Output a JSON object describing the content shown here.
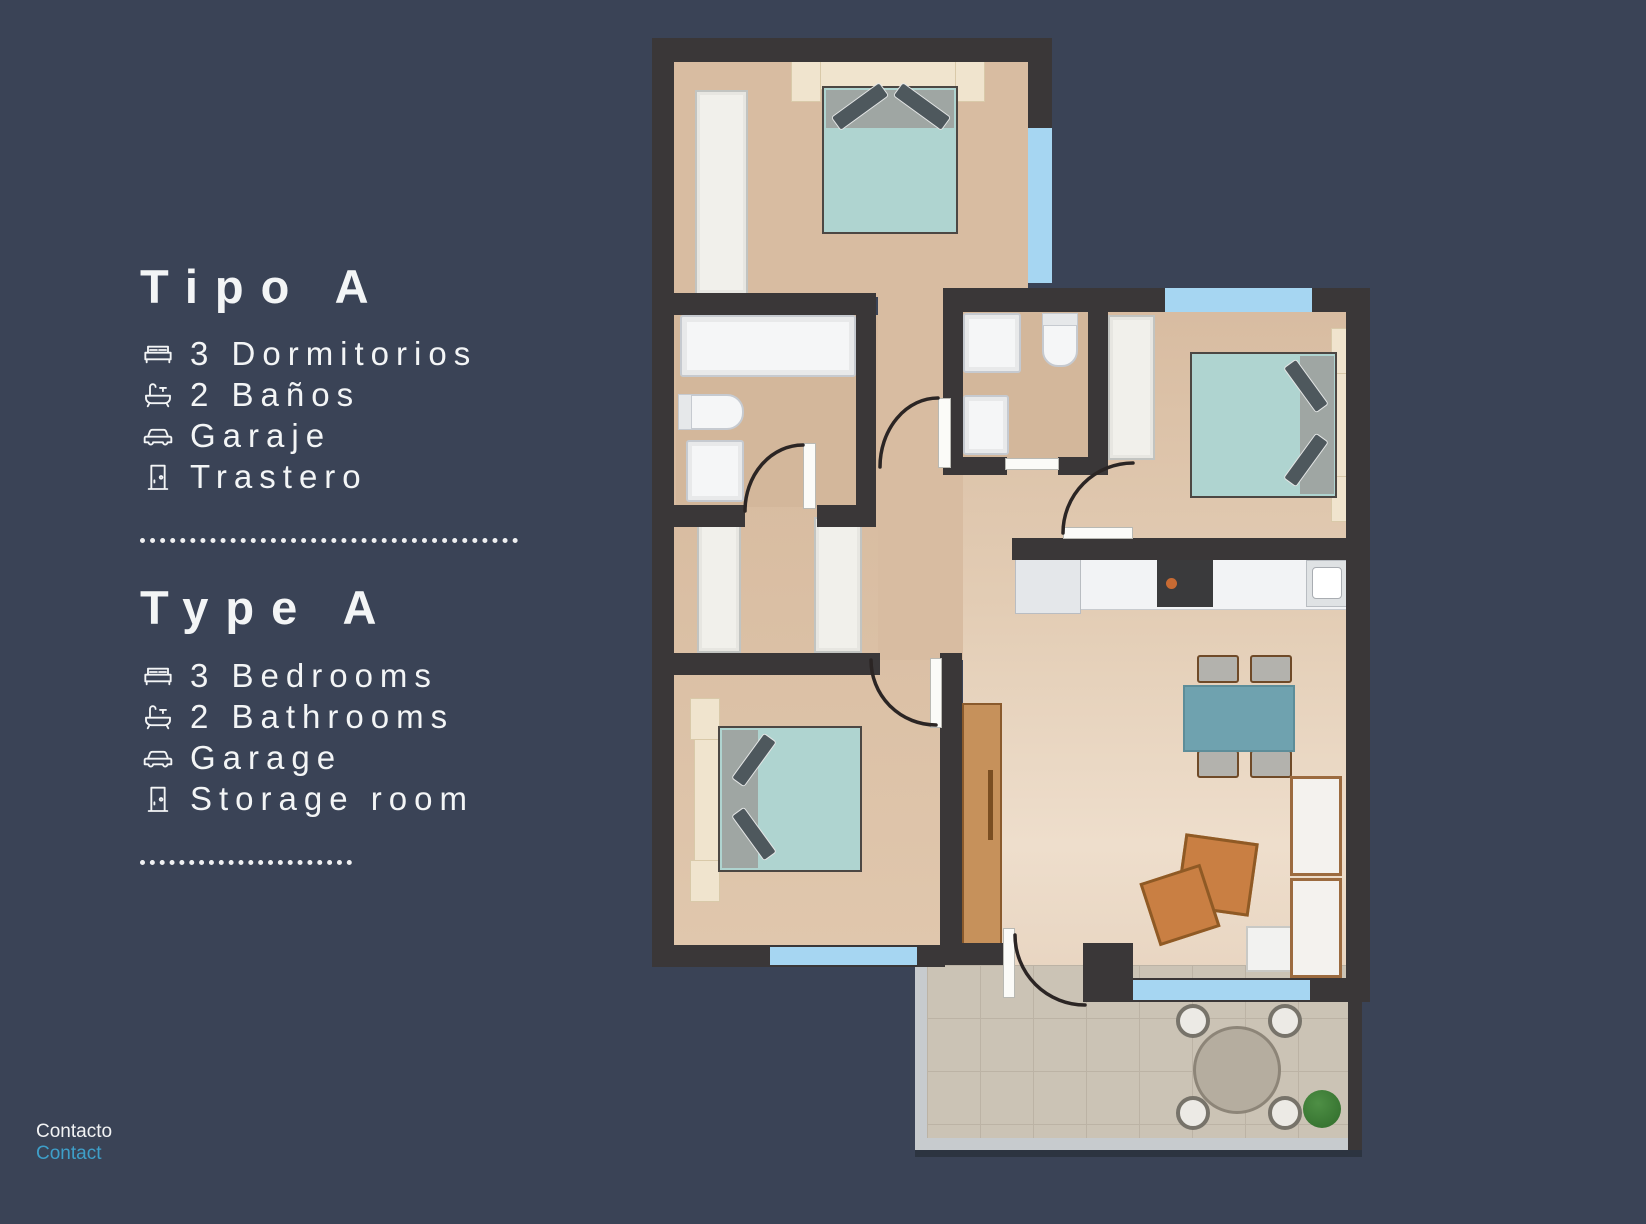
{
  "sections": [
    {
      "title": "Tipo A",
      "items": [
        {
          "icon": "bed-icon",
          "label": "3 Dormitorios"
        },
        {
          "icon": "bathtub-icon",
          "label": "2 Baños"
        },
        {
          "icon": "car-icon",
          "label": "Garaje"
        },
        {
          "icon": "door-icon",
          "label": "Trastero"
        }
      ]
    },
    {
      "title": "Type A",
      "items": [
        {
          "icon": "bed-icon",
          "label": "3 Bedrooms"
        },
        {
          "icon": "bathtub-icon",
          "label": "2 Bathrooms"
        },
        {
          "icon": "car-icon",
          "label": "Garage"
        },
        {
          "icon": "door-icon",
          "label": "Storage room"
        }
      ]
    }
  ],
  "footer": {
    "contact_es": "Contacto",
    "contact_en": "Contact"
  },
  "colors": {
    "background": "#3A4356",
    "text": "#F3F5F6",
    "contact_link": "#3E9FC9",
    "wall": "#3A3738",
    "floor_tan": "#D8BCA1",
    "window_blue": "#A6D6F2",
    "bed_teal": "#AFD4D0",
    "dining_table_teal": "#6FA2AF",
    "armchair_orange": "#C97F43",
    "wood": "#C6915B",
    "terrace_tile": "#CBC3B5"
  }
}
